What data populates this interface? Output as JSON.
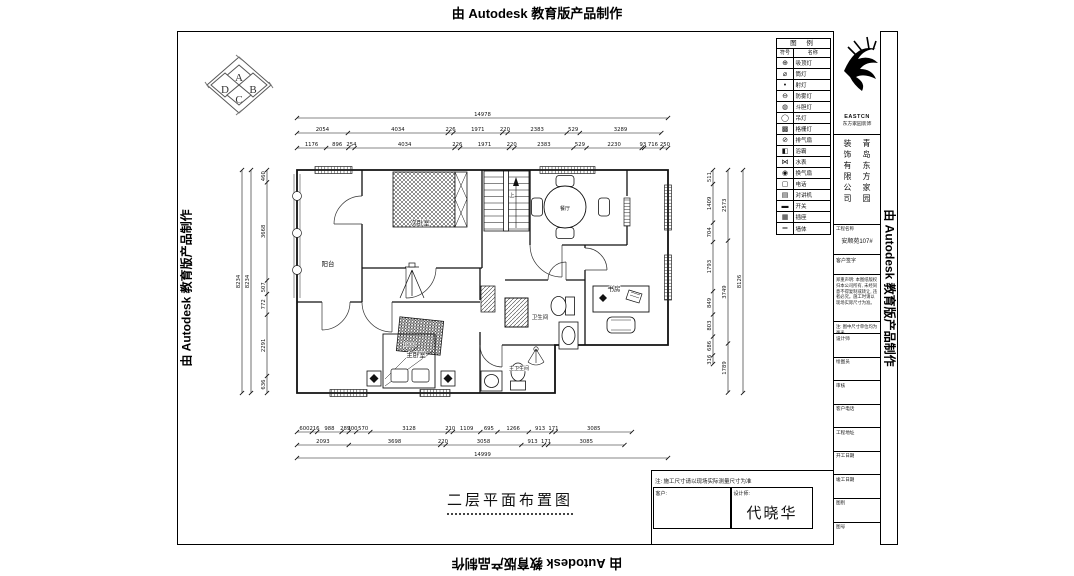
{
  "stamps": {
    "top": "由 Autodesk 教育版产品制作",
    "bottom": "由 Autodesk 教育版产品制作",
    "left": "由 Autodesk 教育版产品制作",
    "right": "由 Autodesk 教育版产品制作"
  },
  "compass": {
    "letters": [
      "A",
      "B",
      "C",
      "D"
    ]
  },
  "plan": {
    "labels": [
      "阳台",
      "次卧室",
      "上",
      "餐厅",
      "书房",
      "卫生间",
      "主卧室",
      "1800",
      "主卫生间"
    ]
  },
  "dimensions": {
    "top": {
      "overall": "14978",
      "row2": [
        "2054",
        "4034",
        "226",
        "1971",
        "220",
        "2383",
        "529",
        "3289"
      ],
      "row3": [
        "1176",
        "896",
        "254",
        "4034",
        "226",
        "1971",
        "220",
        "2383",
        "529",
        "2230",
        "93",
        "716",
        "250"
      ]
    },
    "bottom": {
      "overall": "14999",
      "row1": [
        "600",
        "216",
        "988",
        "289",
        "300",
        "570",
        "3128",
        "210",
        "1109",
        "695",
        "1266",
        "913",
        "171",
        "3085"
      ],
      "row2": [
        "2093",
        "3698",
        "220",
        "3058",
        "913",
        "171",
        "3085"
      ]
    },
    "left": {
      "overall": [
        "8234",
        "8234"
      ],
      "inner": [
        "460",
        "3668",
        "507",
        "772",
        "2291",
        "636"
      ]
    },
    "right": {
      "inner": [
        "511",
        "1409",
        "704",
        "1793",
        "849",
        "803",
        "686",
        "316"
      ],
      "mid": [
        "2573",
        "3749",
        "1789"
      ],
      "overall": "8126"
    }
  },
  "legend": {
    "title": "图 例",
    "col_symbol": "符号",
    "col_name": "名称",
    "rows": [
      {
        "symbol": "⊕",
        "name": "吸顶灯"
      },
      {
        "symbol": "⌀",
        "name": "筒灯"
      },
      {
        "symbol": "•",
        "name": "射灯"
      },
      {
        "symbol": "⊖",
        "name": "防雾灯"
      },
      {
        "symbol": "◍",
        "name": "斗胆灯"
      },
      {
        "symbol": "◯",
        "name": "吊灯"
      },
      {
        "symbol": "▩",
        "name": "格栅灯"
      },
      {
        "symbol": "⊘",
        "name": "排气扇"
      },
      {
        "symbol": "◧",
        "name": "浴霸"
      },
      {
        "symbol": "⋈",
        "name": "水表"
      },
      {
        "symbol": "◉",
        "name": "换气扇"
      },
      {
        "symbol": "▢",
        "name": "电话"
      },
      {
        "symbol": "▤",
        "name": "对讲机"
      },
      {
        "symbol": "▬",
        "name": "开关"
      },
      {
        "symbol": "▦",
        "name": "插座"
      },
      {
        "symbol": "═",
        "name": "墙体"
      }
    ]
  },
  "titleblock": {
    "logo_text": "EASTCN",
    "logo_sub": "东方家园装饰",
    "company_left": "装饰有限公司",
    "company_right": "青岛东方家园",
    "project_label": "工程名称",
    "project_value": "安顺苑107#",
    "sign_label": "客户签字",
    "notice": "郑重声明: 本图纸版权归本公司所有, 未经同意不得复制或转让, 违者必究。施工时请以现场实际尺寸为准。",
    "unit_note": "注: 图中尺寸单位均为毫米",
    "rows": [
      {
        "label": "设计师",
        "value": ""
      },
      {
        "label": "绘图员",
        "value": ""
      },
      {
        "label": "审核",
        "value": ""
      },
      {
        "label": "客户电话",
        "value": ""
      },
      {
        "label": "工程地址",
        "value": ""
      },
      {
        "label": "开工日期",
        "value": ""
      },
      {
        "label": "竣工日期",
        "value": ""
      },
      {
        "label": "图别",
        "value": ""
      },
      {
        "label": "图号",
        "value": ""
      }
    ]
  },
  "footer": {
    "drawing_title": "二层平面布置图",
    "note": "注: 施工尺寸请以现场实际测量尺寸为准",
    "client_label": "客户:",
    "designer_label": "设计师:",
    "designer_name": "代晓华"
  }
}
